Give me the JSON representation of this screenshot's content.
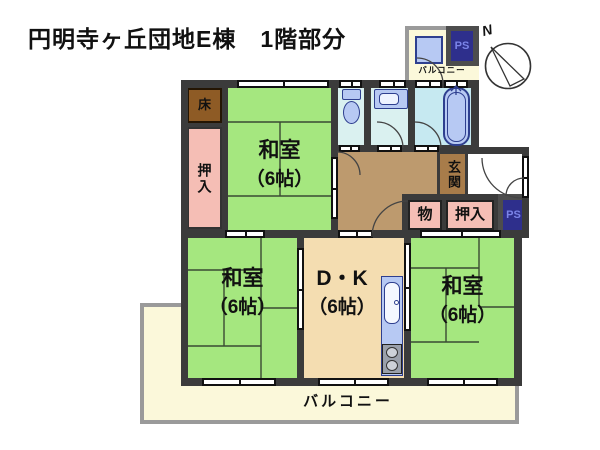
{
  "title": "円明寺ヶ丘団地E棟　1階部分",
  "compass": {
    "north": "N"
  },
  "labels": {
    "room_tl": {
      "name": "和室",
      "size": "（6帖）"
    },
    "room_bl": {
      "name": "和室",
      "size": "（6帖）"
    },
    "room_br": {
      "name": "和室",
      "size": "（6帖）"
    },
    "dk": {
      "name": "D・K",
      "size": "（6帖）"
    },
    "genkan": "玄関",
    "tokonoma": "床",
    "closet_left": "押入",
    "closet_hall": "押入",
    "storage": "物",
    "ps_top": "PS",
    "ps_side": "PS",
    "balcony_top": "バルコニー",
    "balcony_main": "バルコニー"
  },
  "colors": {
    "tatami_green": "#a5e77f",
    "closet_pink": "#f5beb5",
    "tokonoma_brown": "#8e5b25",
    "hall_brown": "#bd9a6e",
    "genkan_brown": "#a87c4a",
    "dk_tan": "#f4ddb1",
    "balcony_cream": "#fbf8da",
    "balcony_border": "#9a9a9a",
    "wet_floor": "#daf1f0",
    "bath_floor": "#c6e9f1",
    "fixture_blue": "#b7c9f3",
    "fixture_edge": "#2e3f8f",
    "ps_navy": "#2e2f8c",
    "ps_text": "#7b84e8",
    "ps_frame": "#4d4d4d",
    "wall_dark": "#3b3b3b"
  }
}
